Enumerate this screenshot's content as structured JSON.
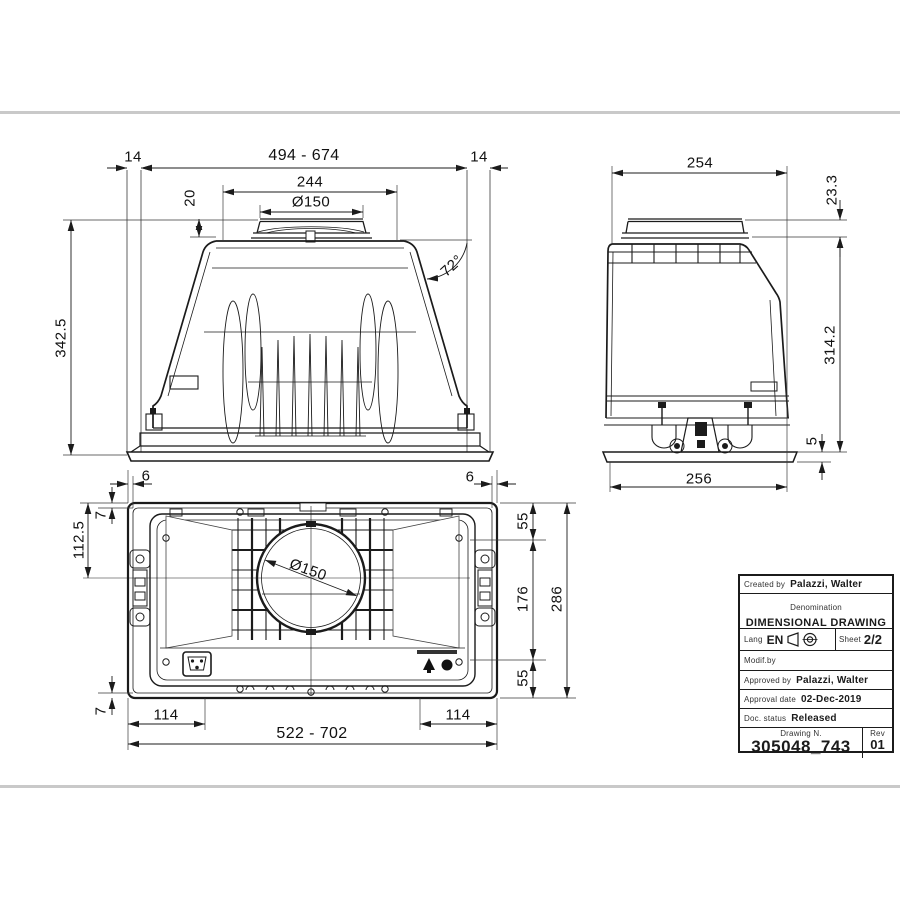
{
  "colors": {
    "background": "#ffffff",
    "line": "#1b1b1b",
    "divider": "#c9c9c9"
  },
  "front_view": {
    "dims": {
      "overhang_left": "14",
      "width_range": "494 - 674",
      "overhang_right": "14",
      "top_panel_width": "244",
      "duct_diameter": "Ø150",
      "collar_height": "20",
      "wall_angle": "72°",
      "total_height": "342.5"
    }
  },
  "side_view": {
    "dims": {
      "top_width": "254",
      "collar_height": "23.3",
      "body_height": "314.2",
      "flange_gap": "5",
      "bottom_width": "256"
    }
  },
  "plan_view": {
    "dims": {
      "edge_left": "6",
      "edge_right": "6",
      "rim_top": "7",
      "duct_center_offset": "112.5",
      "duct_diameter": "Ø150",
      "margin_top": "55",
      "hinge_pitch": "176",
      "depth": "286",
      "margin_bottom": "55",
      "rim_bottom": "7",
      "bracket_left": "114",
      "width_range": "522 - 702",
      "bracket_right": "114"
    }
  },
  "title_block": {
    "created_by_label": "Created by",
    "created_by": "Palazzi, Walter",
    "denomination_label": "Denomination",
    "denomination": "DIMENSIONAL DRAWING",
    "lang_label": "Lang",
    "lang": "EN",
    "sheet_label": "Sheet",
    "sheet": "2/2",
    "modif_by_label": "Modif.by",
    "approved_by_label": "Approved by",
    "approved_by": "Palazzi, Walter",
    "approval_date_label": "Approval date",
    "approval_date": "02-Dec-2019",
    "doc_status_label": "Doc. status",
    "doc_status": "Released",
    "drawing_n_label": "Drawing N.",
    "drawing_n": "305048_743",
    "rev_label": "Rev",
    "rev": "01"
  }
}
